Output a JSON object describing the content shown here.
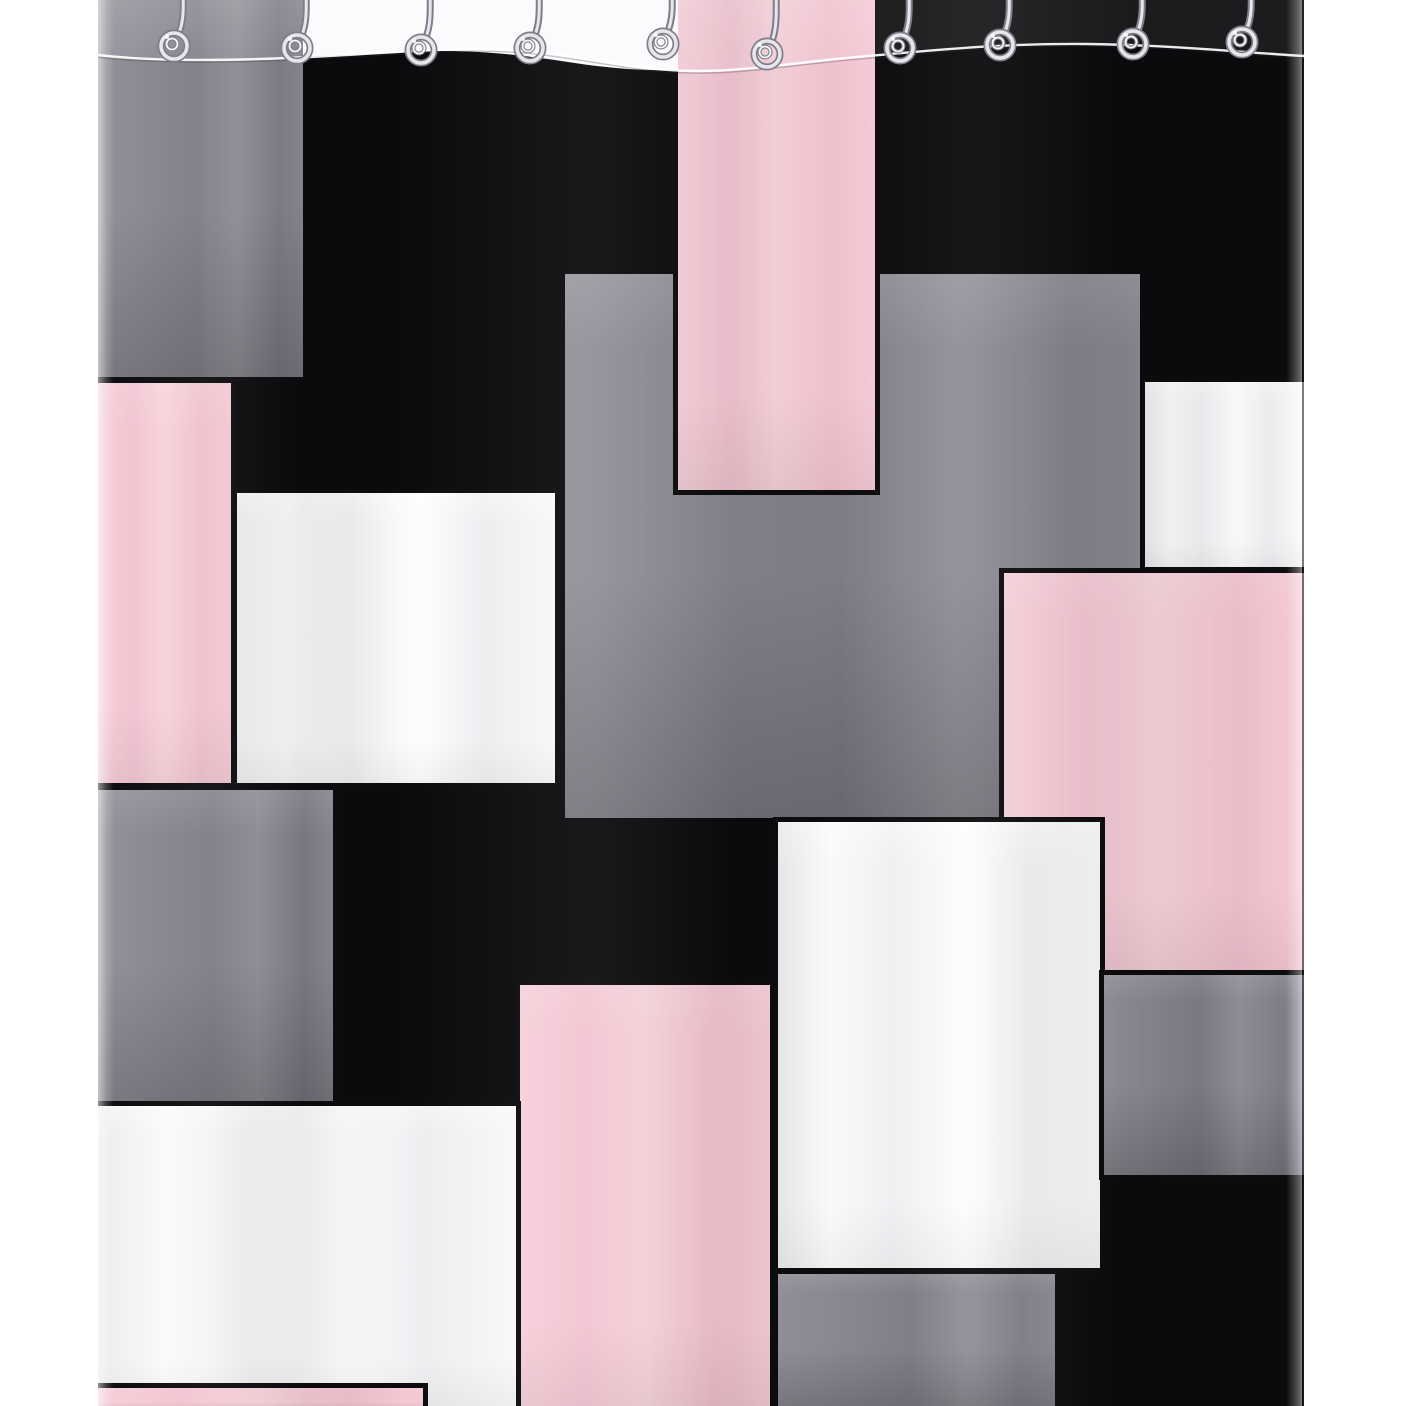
{
  "meta": {
    "domain": "Natural-Image",
    "subject": "geometric color-block patchwork shower curtain hanging on spiral metal hooks",
    "background": "white seamless product backdrop"
  },
  "canvas": {
    "width": 1406,
    "height": 1406
  },
  "palette": {
    "backdrop_white": "#ffffff",
    "curtain_black": "#0b0a0c",
    "border_black": "#0c0b0d",
    "patch_gray": "#8a8791",
    "patch_pink": "#f3c6d2",
    "patch_white": "#f6f5f7",
    "hook_metal_dark": "#7f7d87",
    "hook_metal_mid": "#e7e6ed",
    "hook_metal_light": "#f7f7fb",
    "fold_highlight": "#ffffff"
  },
  "curtain": {
    "left": 98,
    "top": 0,
    "width": 1206,
    "height": 1406,
    "blocks": [
      {
        "id": "patch-gray-top-left",
        "color": "gray",
        "x": 0,
        "y": 0,
        "w": 205,
        "h": 377
      },
      {
        "id": "patch-gray-center",
        "color": "gray",
        "x": 467,
        "y": 274,
        "w": 575,
        "h": 544,
        "noborder": true
      },
      {
        "id": "patch-pink-right",
        "color": "pink",
        "x": 906,
        "y": 573,
        "w": 300,
        "h": 397
      },
      {
        "id": "patch-white-right",
        "color": "white",
        "x": 1047,
        "y": 382,
        "w": 159,
        "h": 185
      },
      {
        "id": "patch-pink-top-column",
        "color": "pink",
        "x": 580,
        "y": 0,
        "w": 197,
        "h": 490
      },
      {
        "id": "patch-pink-upper-left",
        "color": "pink",
        "x": 0,
        "y": 383,
        "w": 133,
        "h": 400
      },
      {
        "id": "patch-white-upper-left",
        "color": "white",
        "x": 139,
        "y": 493,
        "w": 318,
        "h": 290
      },
      {
        "id": "patch-gray-mid-left",
        "color": "gray",
        "x": 0,
        "y": 790,
        "w": 235,
        "h": 316
      },
      {
        "id": "patch-white-center-bottom",
        "color": "white",
        "x": 680,
        "y": 822,
        "w": 322,
        "h": 446
      },
      {
        "id": "patch-gray-right-lower",
        "color": "gray",
        "x": 1006,
        "y": 975,
        "w": 200,
        "h": 200
      },
      {
        "id": "patch-pink-bottom-center",
        "color": "pink",
        "x": 422,
        "y": 985,
        "w": 250,
        "h": 421
      },
      {
        "id": "patch-white-bottom-left",
        "color": "white",
        "x": 0,
        "y": 1106,
        "w": 418,
        "h": 300
      },
      {
        "id": "patch-pink-bottom-strip",
        "color": "pink",
        "x": 0,
        "y": 1388,
        "w": 325,
        "h": 18
      },
      {
        "id": "patch-gray-bottom-center",
        "color": "gray",
        "x": 680,
        "y": 1274,
        "w": 277,
        "h": 132
      }
    ]
  },
  "top_trim": {
    "svg_width": 1206,
    "svg_height": 130,
    "header_band_fill": "#fbfafc",
    "header_band_path": "M205,0 L580,0 L580,70 C550,71 515,69 470,62 C430,56 390,51 345,51 C300,52 255,56 205,56 Z",
    "above_fold_tint_path": "M0,0 L1206,0 L1206,56 C1140,52 1070,45 990,44 C900,43 830,51 770,56 C700,62 650,71 600,71 C540,71 490,57 430,51 C370,46 320,51 230,56 C140,61 60,62 0,55 Z",
    "fold_line_path": "M0,55 C60,62 140,61 230,56 C320,51 370,46 430,51 C490,57 540,71 600,71 C650,71 700,62 770,56 C830,51 900,43 990,44 C1070,45 1140,52 1206,56"
  },
  "hooks": {
    "count": 10,
    "positions": [
      {
        "x": 80,
        "coil_y": 46
      },
      {
        "x": 203,
        "coil_y": 48
      },
      {
        "x": 327,
        "coil_y": 50
      },
      {
        "x": 436,
        "coil_y": 48
      },
      {
        "x": 569,
        "coil_y": 44
      },
      {
        "x": 673,
        "coil_y": 54
      },
      {
        "x": 806,
        "coil_y": 48
      },
      {
        "x": 906,
        "coil_y": 45
      },
      {
        "x": 1039,
        "coil_y": 44
      },
      {
        "x": 1148,
        "coil_y": 42
      }
    ]
  }
}
